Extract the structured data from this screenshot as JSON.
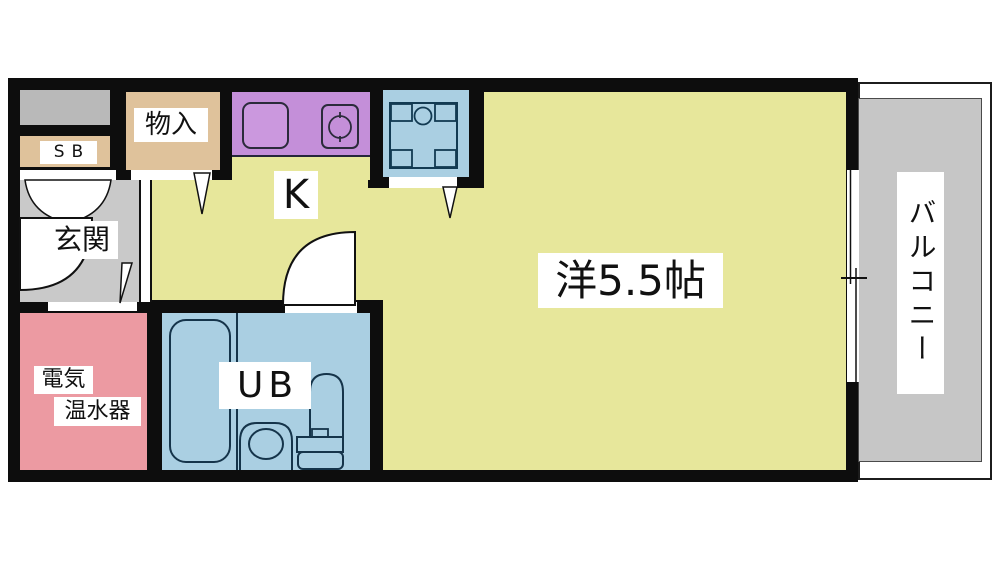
{
  "floorplan": {
    "type": "japanese-apartment-floor-plan",
    "rooms": {
      "entrance": {
        "label": "玄関"
      },
      "shoe_box": {
        "label": "SB"
      },
      "storage": {
        "label": "物入"
      },
      "kitchen": {
        "label": "K"
      },
      "main_room": {
        "label": "洋5.5帖"
      },
      "unit_bath": {
        "label": "UB"
      },
      "water_heater": {
        "label_line1": "電気",
        "label_line2": "温水器"
      },
      "balcony": {
        "label": "バルコニー"
      }
    },
    "fixtures": [
      "kitchen-sink",
      "stove-burner",
      "washing-machine-pan",
      "bathtub",
      "washbasin",
      "toilet",
      "sliding-window",
      "entrance-door-swing",
      "unit-bath-door-swing",
      "double-closet-door-swing",
      "hinged-door-panel-triangles"
    ],
    "colors": {
      "wall": "#0d0d0d",
      "floor_main": "#e7e79b",
      "floor_entrance": "#c9c9c9",
      "floor_balcony": "#c6c6c6",
      "closet_tan": "#dfc29b",
      "counter_purple": "#c48fd9",
      "bath_blue": "#aacfe2",
      "heater_pink": "#ec9aa2",
      "meter_gray": "#b9b9b9",
      "fixture_stroke": "#15344a"
    }
  }
}
